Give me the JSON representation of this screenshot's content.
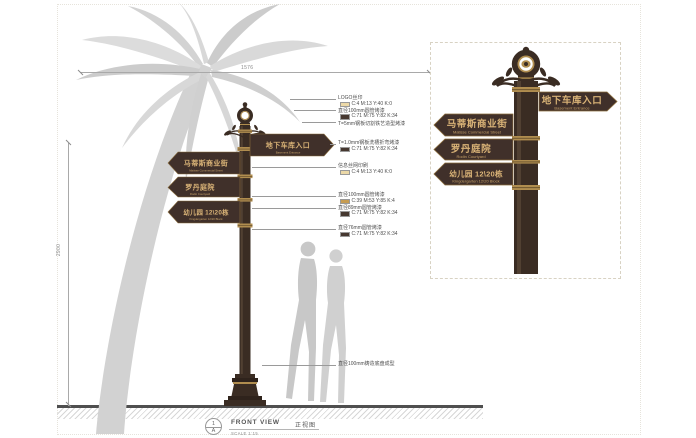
{
  "palette": {
    "pole_dark": "#3a2c23",
    "pole_highlight": "#5b4839",
    "gold": "#b08d4f",
    "sign_plate": "#40302a",
    "sign_text": "#d9b377",
    "swatch_cream": "#ecd9a8",
    "swatch_dark": "#463830",
    "swatch_gold": "#c69c52",
    "silhouette_gray": "#cdcdcd",
    "palm_gray": "#d5d5d5"
  },
  "dimensions": {
    "top_width": "1576",
    "left_height": "2900"
  },
  "pole_signs": [
    {
      "cn": "地下车库入口",
      "en": "Basement Entrance",
      "direction": "right"
    },
    {
      "cn": "马蒂斯商业街",
      "en": "Matisse Commercial Street",
      "direction": "left"
    },
    {
      "cn": "罗丹庭院",
      "en": "Rodin Courtyard",
      "direction": "left"
    },
    {
      "cn": "幼儿园  12\\20栋",
      "en": "Kingdergarten  12\\20 Block",
      "direction": "left"
    }
  ],
  "annotation_blocks": [
    {
      "lines": [
        {
          "text": "LOGO丝印"
        },
        {
          "swatch": "cream",
          "text": "C:4 M:13 Y:40 K:0"
        },
        {
          "text": "直径100mm圆管烤漆"
        },
        {
          "swatch": "dark",
          "text": "C:71 M:75 Y:82 K:34"
        },
        {
          "text": "T=5mm钢板切割铁艺造型烤漆"
        }
      ]
    },
    {
      "lines": [
        {
          "text": "T=1.0mm钢板洗槽折弯烤漆"
        },
        {
          "swatch": "dark",
          "text": "C:71 M:75 Y:82 K:34"
        }
      ]
    },
    {
      "lines": [
        {
          "text": "信息丝网印刷"
        },
        {
          "swatch": "cream",
          "text": "C:4 M:13 Y:40 K:0"
        }
      ]
    },
    {
      "lines": [
        {
          "text": "直径100mm圆管烤漆"
        },
        {
          "swatch": "gold",
          "text": "C:39 M:53 Y:85 K:4"
        },
        {
          "text": "直径89mm圆管烤漆"
        },
        {
          "swatch": "dark",
          "text": "C:71 M:75 Y:82 K:34"
        }
      ]
    },
    {
      "lines": [
        {
          "text": "直径76mm圆管烤漆"
        },
        {
          "swatch": "dark",
          "text": "C:71 M:75 Y:82 K:34"
        }
      ]
    },
    {
      "lines": [
        {
          "text": "直径100mm铸造底盘成型"
        }
      ]
    }
  ],
  "title_block": {
    "number": "1",
    "letter": "A",
    "name_en": "FRONT VIEW",
    "name_cn": "正视图",
    "scale": "SCALE 1:15"
  }
}
